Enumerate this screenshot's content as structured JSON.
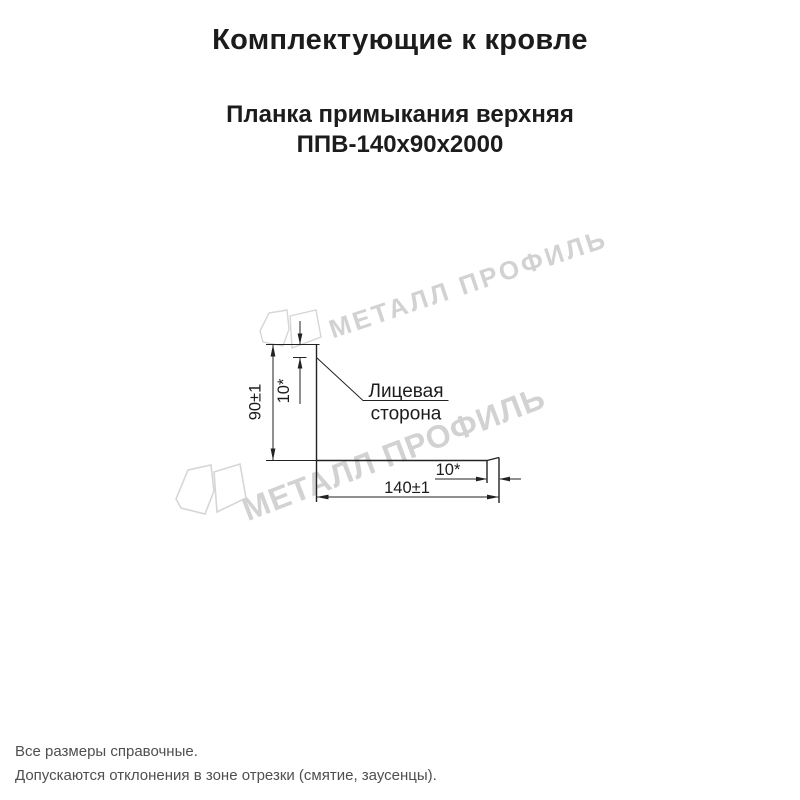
{
  "page": {
    "title": "Комплектующие к кровле",
    "subtitle_line1": "Планка примыкания верхняя",
    "subtitle_line2": "ППВ-140х90х2000"
  },
  "watermark": {
    "text": "МЕТАЛЛ ПРОФИЛЬ"
  },
  "drawing": {
    "product": "Планка примыкания верхняя ППВ-140х90х2000",
    "labels": {
      "height_dim": "90±1",
      "top_flange_dim": "10*",
      "width_dim": "140±1",
      "right_flange_dim": "10*",
      "face_side_line1": "Лицевая",
      "face_side_line2": "сторона"
    }
  },
  "footer": {
    "line1": "Все размеры справочные.",
    "line2": "Допускаются отклонения в зоне отрезки (смятие, заусенцы)."
  },
  "colors": {
    "line": "#222222",
    "text": "#1c1c1c",
    "watermark": "#d2d2d2",
    "footer_text": "#4f4f4f",
    "background": "#ffffff"
  }
}
